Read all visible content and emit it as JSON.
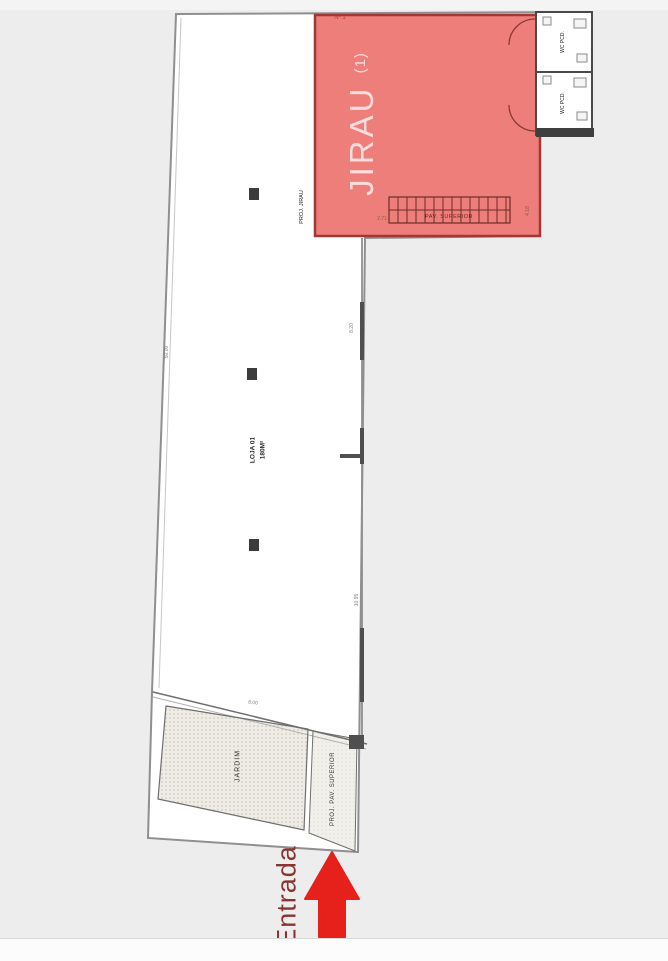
{
  "plan": {
    "unit_number": "Nº 1",
    "mezzanine_label": "JIRAU",
    "mezzanine_suffix": "(1)",
    "mezzanine_projection_label": "PROJ. JIRAU",
    "stairs_label": "PAV. SUPERIOR",
    "wc_top_label": "WC PCD.",
    "wc_bottom_label": "WC PCD.",
    "store_name": "LOJA 01",
    "store_area": "180M²",
    "garden_label": "JARDIM",
    "upper_floor_projection_label": "PROJ. PAV. SUPERIOR",
    "entrance_label": "Entrada",
    "dimensions": {
      "left_boundary": "50.00",
      "mid_right_wall": "8.20",
      "lower_right_wall": "10.95",
      "stair_left": "2.71",
      "stair_right": "4.18",
      "garden_top": "8.00"
    },
    "colors": {
      "mezzanine_fill": "#ee7e7a",
      "mezzanine_border": "#a23833",
      "entrance_text_color": "#8a3431",
      "entrance_arrow_color": "#e6201a",
      "wall_dark": "#4f4f4f",
      "boundary_gray": "#8f8f8f"
    }
  }
}
